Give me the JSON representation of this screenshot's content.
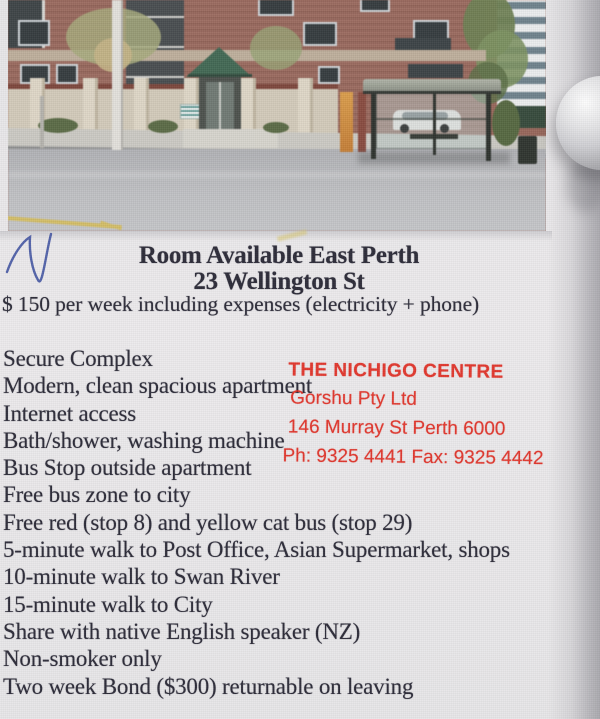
{
  "page": {
    "background_color": "#e9e8ea",
    "edge_shade_color": "#8f8f93"
  },
  "annotation": {
    "handwritten_mark": "N",
    "ink_color": "#3f51a0"
  },
  "flyer": {
    "title": "Room Available East Perth",
    "address": "23 Wellington St",
    "price_line": "$ 150 per week including expenses (electricity + phone)",
    "features": [
      "Secure Complex",
      "Modern, clean spacious apartment",
      "Internet access",
      "Bath/shower, washing machine",
      "Bus Stop outside apartment",
      "Free bus zone to city",
      "Free red (stop 8) and yellow cat bus (stop 29)",
      "5-minute walk to Post Office, Asian Supermarket, shops",
      "10-minute walk to Swan River",
      "15-minute walk to City",
      "Share with native English speaker (NZ)",
      "Non-smoker only",
      "Two week Bond ($300) returnable on leaving"
    ],
    "text_color": "#2e2d3a"
  },
  "stamp": {
    "name": "THE NICHIGO CENTRE",
    "company": "Gorshu Pty Ltd",
    "address": "146 Murray St Perth 6000",
    "phone_fax": "Ph: 9325 4441  Fax: 9325 4442",
    "color": "#e0271c"
  },
  "photo": {
    "subject": "apartment-building-with-bus-stop",
    "brick_color": "#9b675b",
    "awning_color": "#406853",
    "fence_color": "#d8cfbe",
    "street_color": "#bdbec2"
  }
}
